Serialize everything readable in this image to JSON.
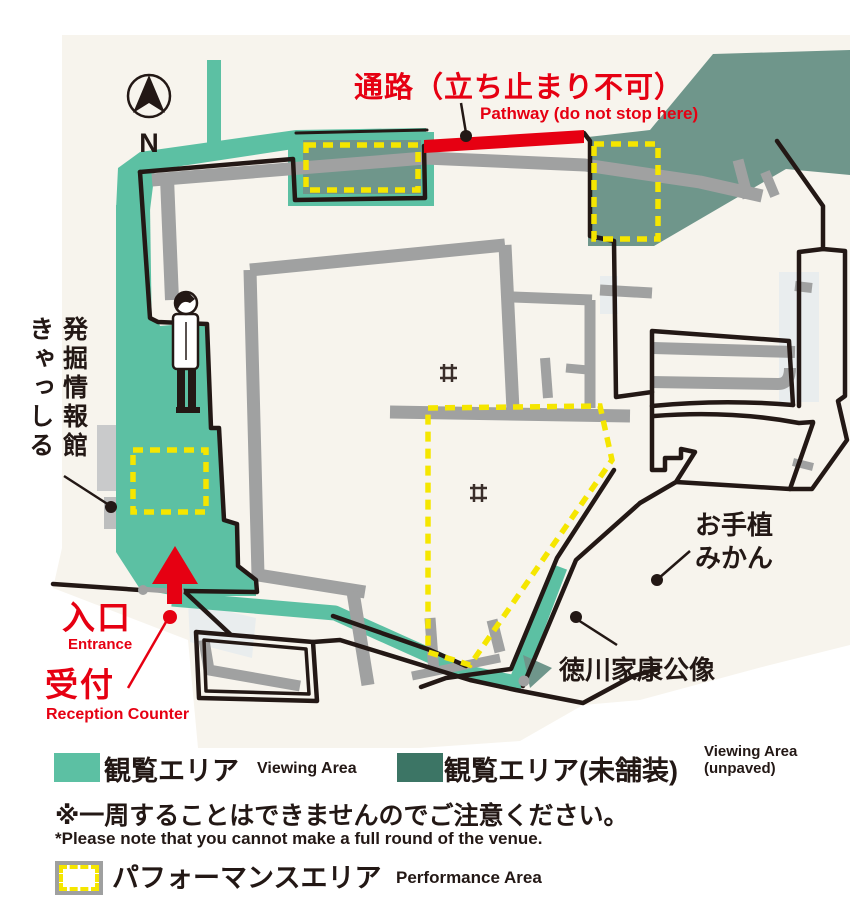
{
  "compass": {
    "north_label": "N"
  },
  "annotations": {
    "pathway": {
      "jp": "通路（立ち止まり不可）",
      "en": "Pathway (do not stop here)"
    },
    "museum": {
      "line1": "発掘情報館",
      "line2": "きゃっしる"
    },
    "entrance": {
      "jp": "入口",
      "en": "Entrance"
    },
    "reception": {
      "jp": "受付",
      "en": "Reception Counter"
    },
    "mikan": {
      "line1": "お手植",
      "line2": "みかん"
    },
    "statue": {
      "jp": "徳川家康公像"
    }
  },
  "legend": {
    "viewing_area": {
      "jp": "観覧エリア",
      "en": "Viewing Area",
      "color": "#5cc0a3"
    },
    "viewing_area_unpaved": {
      "jp": "観覧エリア(未舗装)",
      "en_line1": "Viewing Area",
      "en_line2": "(unpaved)",
      "color": "#3c7565"
    },
    "performance_area": {
      "jp": "パフォーマンスエリア",
      "en": "Performance Area",
      "border_color": "#f5e600"
    },
    "note": {
      "jp": "※一周することはできませんのでご注意ください。",
      "en": "*Please note that you cannot make a full round of the venue."
    }
  },
  "colors": {
    "paper": "#f7f4ed",
    "viewing_area_teal": "#5cc0a3",
    "unpaved_sage_on_map": "#6f968b",
    "legend_unpaved_swatch": "#3c7565",
    "performance_dash_yellow": "#f5e600",
    "pathway_red": "#e60012",
    "path_gray": "#a0a1a1",
    "outline_ink": "#231815"
  }
}
